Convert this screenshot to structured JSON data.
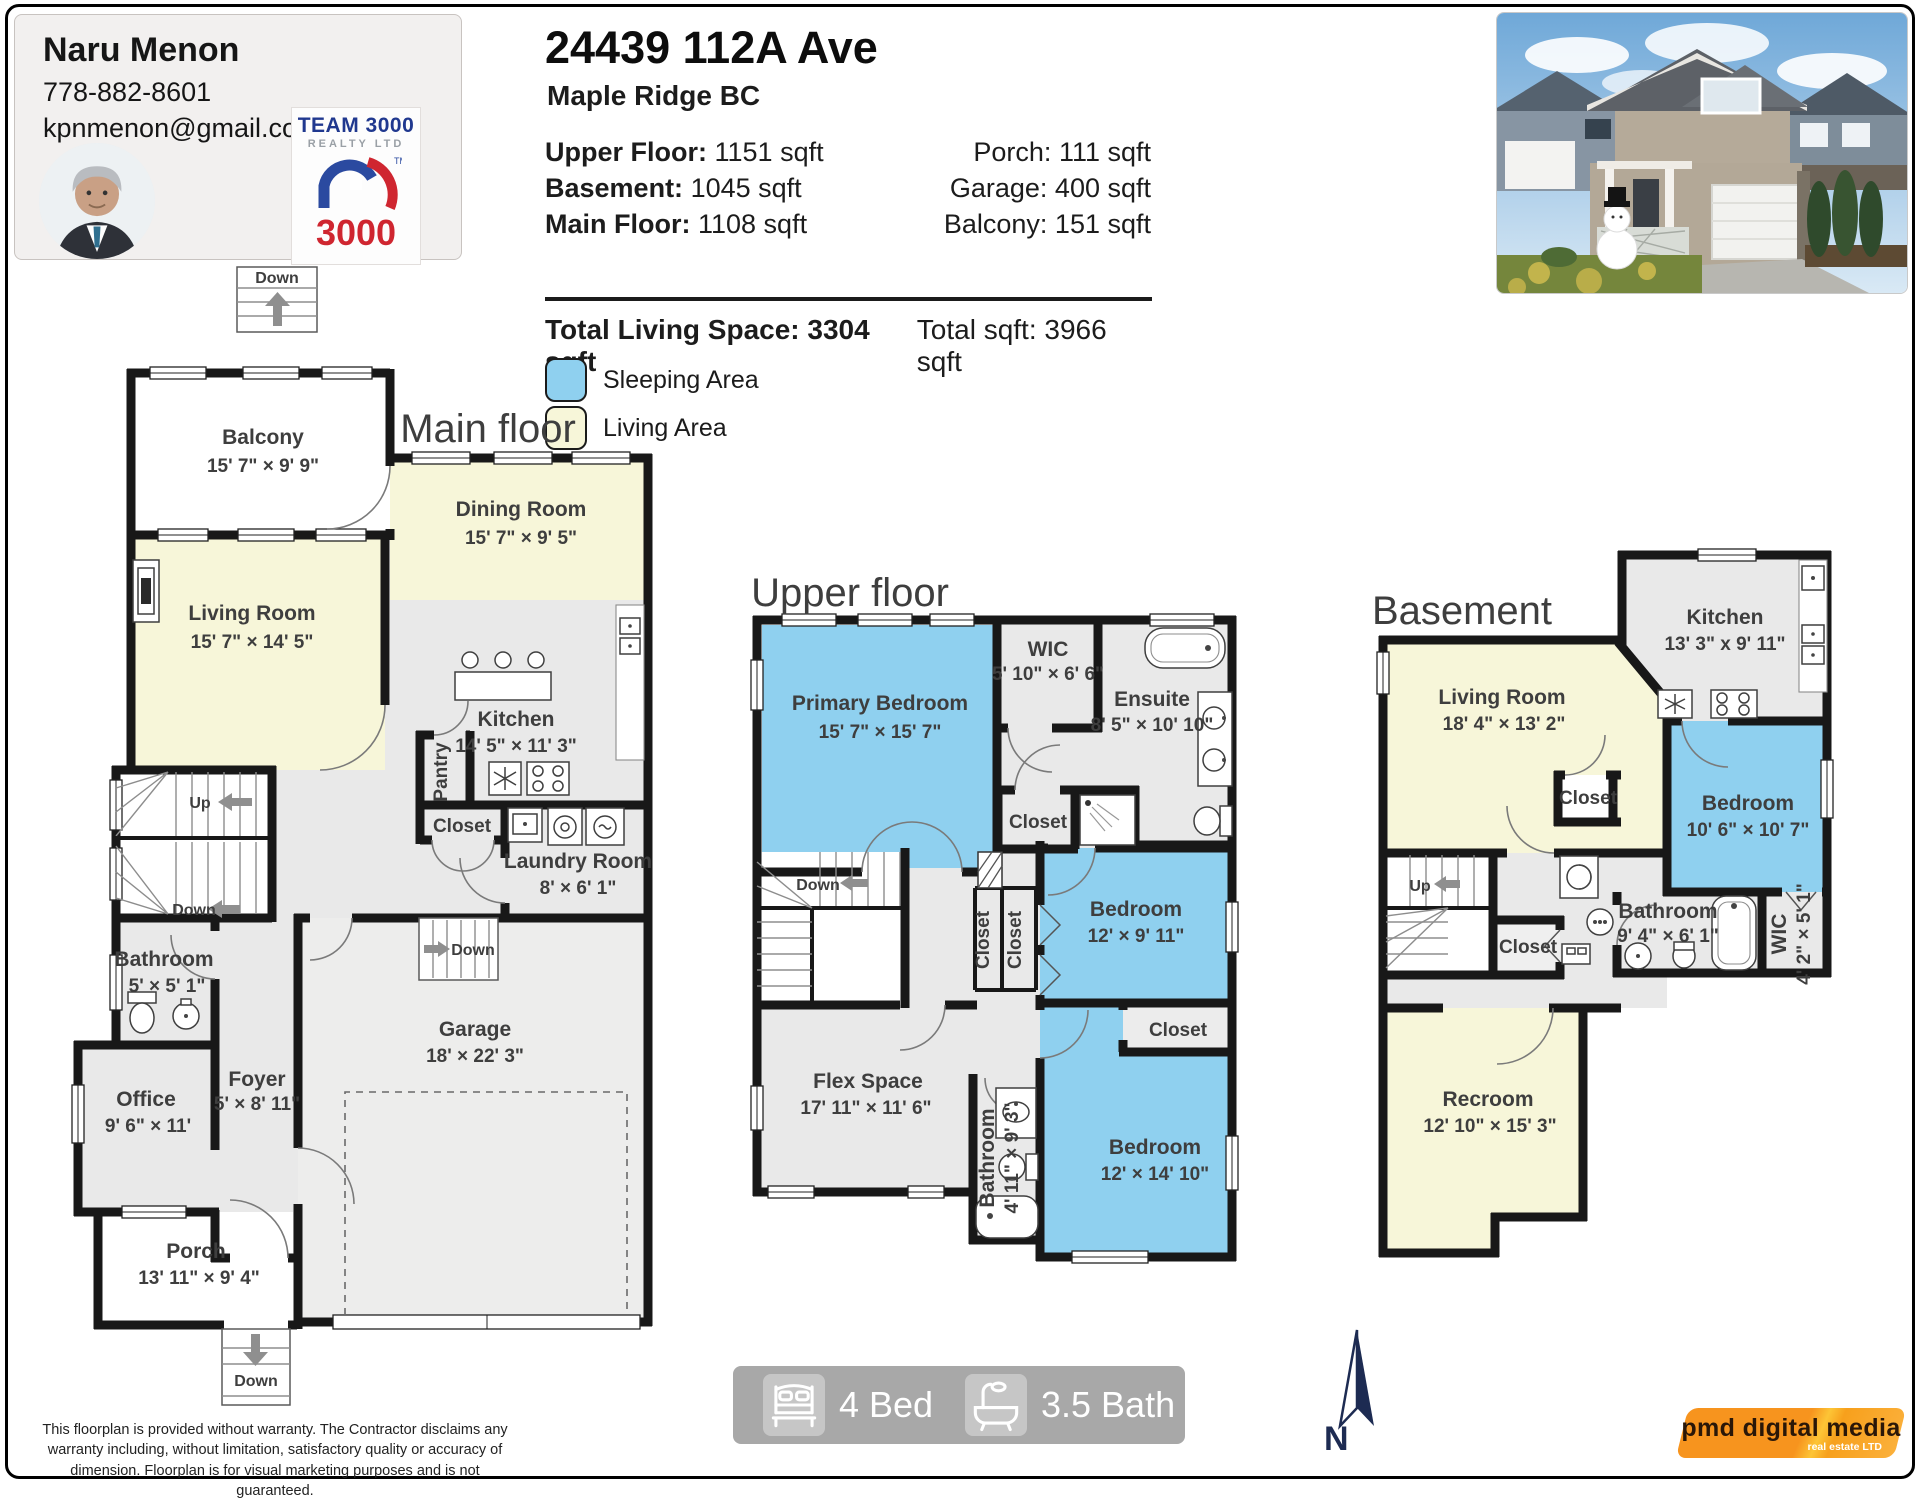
{
  "agent": {
    "name": "Naru Menon",
    "phone": "778-882-8601",
    "email": "kpnmenon@gmail.com",
    "brokerage": {
      "line1": "TEAM 3000",
      "line2": "REALTY LTD",
      "number": "3000",
      "tm": "TM"
    }
  },
  "header": {
    "address": "24439 112A Ave",
    "city": "Maple Ridge BC",
    "stats_left": [
      {
        "label": "Upper Floor:",
        "value": "1151 sqft"
      },
      {
        "label": "Basement:",
        "value": "1045 sqft"
      },
      {
        "label": "Main Floor:",
        "value": "1108 sqft"
      }
    ],
    "stats_right": [
      {
        "label": "Porch:",
        "value": "111 sqft"
      },
      {
        "label": "Garage:",
        "value": "400 sqft"
      },
      {
        "label": "Balcony:",
        "value": "151 sqft"
      }
    ],
    "total_living_label": "Total Living Space:",
    "total_living_value": "3304 sqft",
    "total_label": "Total sqft:",
    "total_value": "3966 sqft",
    "legend": [
      {
        "label": "Sleeping Area",
        "color": "#8fd0ef"
      },
      {
        "label": "Living Area",
        "color": "#f7f6d9"
      }
    ]
  },
  "floors": {
    "main": {
      "title": "Main floor",
      "rooms": {
        "balcony": {
          "name": "Balcony",
          "dims": "15' 7\" × 9' 9\""
        },
        "dining": {
          "name": "Dining Room",
          "dims": "15' 7\" × 9' 5\""
        },
        "living": {
          "name": "Living Room",
          "dims": "15' 7\" × 14' 5\""
        },
        "kitchen": {
          "name": "Kitchen",
          "dims": "14' 5\" × 11' 3\""
        },
        "pantry": {
          "name": "Pantry"
        },
        "closet": {
          "name": "Closet"
        },
        "laundry": {
          "name": "Laundry Room",
          "dims": "8' × 6' 1\""
        },
        "bathroom": {
          "name": "Bathroom",
          "dims": "5' × 5' 1\""
        },
        "office": {
          "name": "Office",
          "dims": "9' 6\" × 11'"
        },
        "foyer": {
          "name": "Foyer",
          "dims": "5' × 8' 11\""
        },
        "garage": {
          "name": "Garage",
          "dims": "18' × 22' 3\""
        },
        "porch": {
          "name": "Porch",
          "dims": "13' 11\" × 9' 4\""
        }
      },
      "stairs": {
        "top": "Down",
        "up": "Up",
        "mid": "Down",
        "garage": "Down",
        "porch": "Down"
      }
    },
    "upper": {
      "title": "Upper floor",
      "rooms": {
        "primary": {
          "name": "Primary Bedroom",
          "dims": "15' 7\" × 15' 7\""
        },
        "wic": {
          "name": "WIC",
          "dims": "5' 10\" × 6' 6\""
        },
        "ensuite": {
          "name": "Ensuite",
          "dims": "8' 5\" × 10' 10\""
        },
        "closet1": {
          "name": "Closet"
        },
        "closet2": {
          "name": "Closet"
        },
        "closet3": {
          "name": "Closet"
        },
        "bedroom1": {
          "name": "Bedroom",
          "dims": "12' × 9' 11\""
        },
        "closet4": {
          "name": "Closet"
        },
        "bedroom2": {
          "name": "Bedroom",
          "dims": "12' × 14' 10\""
        },
        "bathroom": {
          "name": "Bathroom",
          "dims": "4' 11\" × 9' 3\""
        },
        "flex": {
          "name": "Flex Space",
          "dims": "17' 11\" × 11' 6\""
        }
      },
      "stairs": {
        "down": "Down"
      }
    },
    "basement": {
      "title": "Basement",
      "rooms": {
        "living": {
          "name": "Living Room",
          "dims": "18' 4\" × 13' 2\""
        },
        "kitchen": {
          "name": "Kitchen",
          "dims": "13' 3\" x 9' 11\""
        },
        "bedroom": {
          "name": "Bedroom",
          "dims": "10' 6\" × 10' 7\""
        },
        "closet1": {
          "name": "Closet"
        },
        "closet2": {
          "name": "Closet"
        },
        "bathroom": {
          "name": "Bathroom",
          "dims": "9' 4\" × 6' 1\""
        },
        "wic": {
          "name": "WIC",
          "dims": "4' 2\" × 5' 1\""
        },
        "recroom": {
          "name": "Recroom",
          "dims": "12' 10\" × 15' 3\""
        }
      },
      "stairs": {
        "up": "Up"
      }
    }
  },
  "summary": {
    "beds": "4 Bed",
    "baths": "3.5 Bath"
  },
  "compass": {
    "label": "N"
  },
  "branding": {
    "name": "pmd digital media",
    "subtitle": "real estate LTD"
  },
  "disclaimer": "This floorplan is provided without warranty. The Contractor disclaims any warranty including, without limitation, satisfactory quality or accuracy of dimension. Floorplan is for visual marketing purposes and is not guaranteed.",
  "colors": {
    "sleeping_area": "#8fd0ef",
    "living_area": "#f7f6d9",
    "wall": "#181818",
    "room_gray": "#e9e9e9"
  }
}
